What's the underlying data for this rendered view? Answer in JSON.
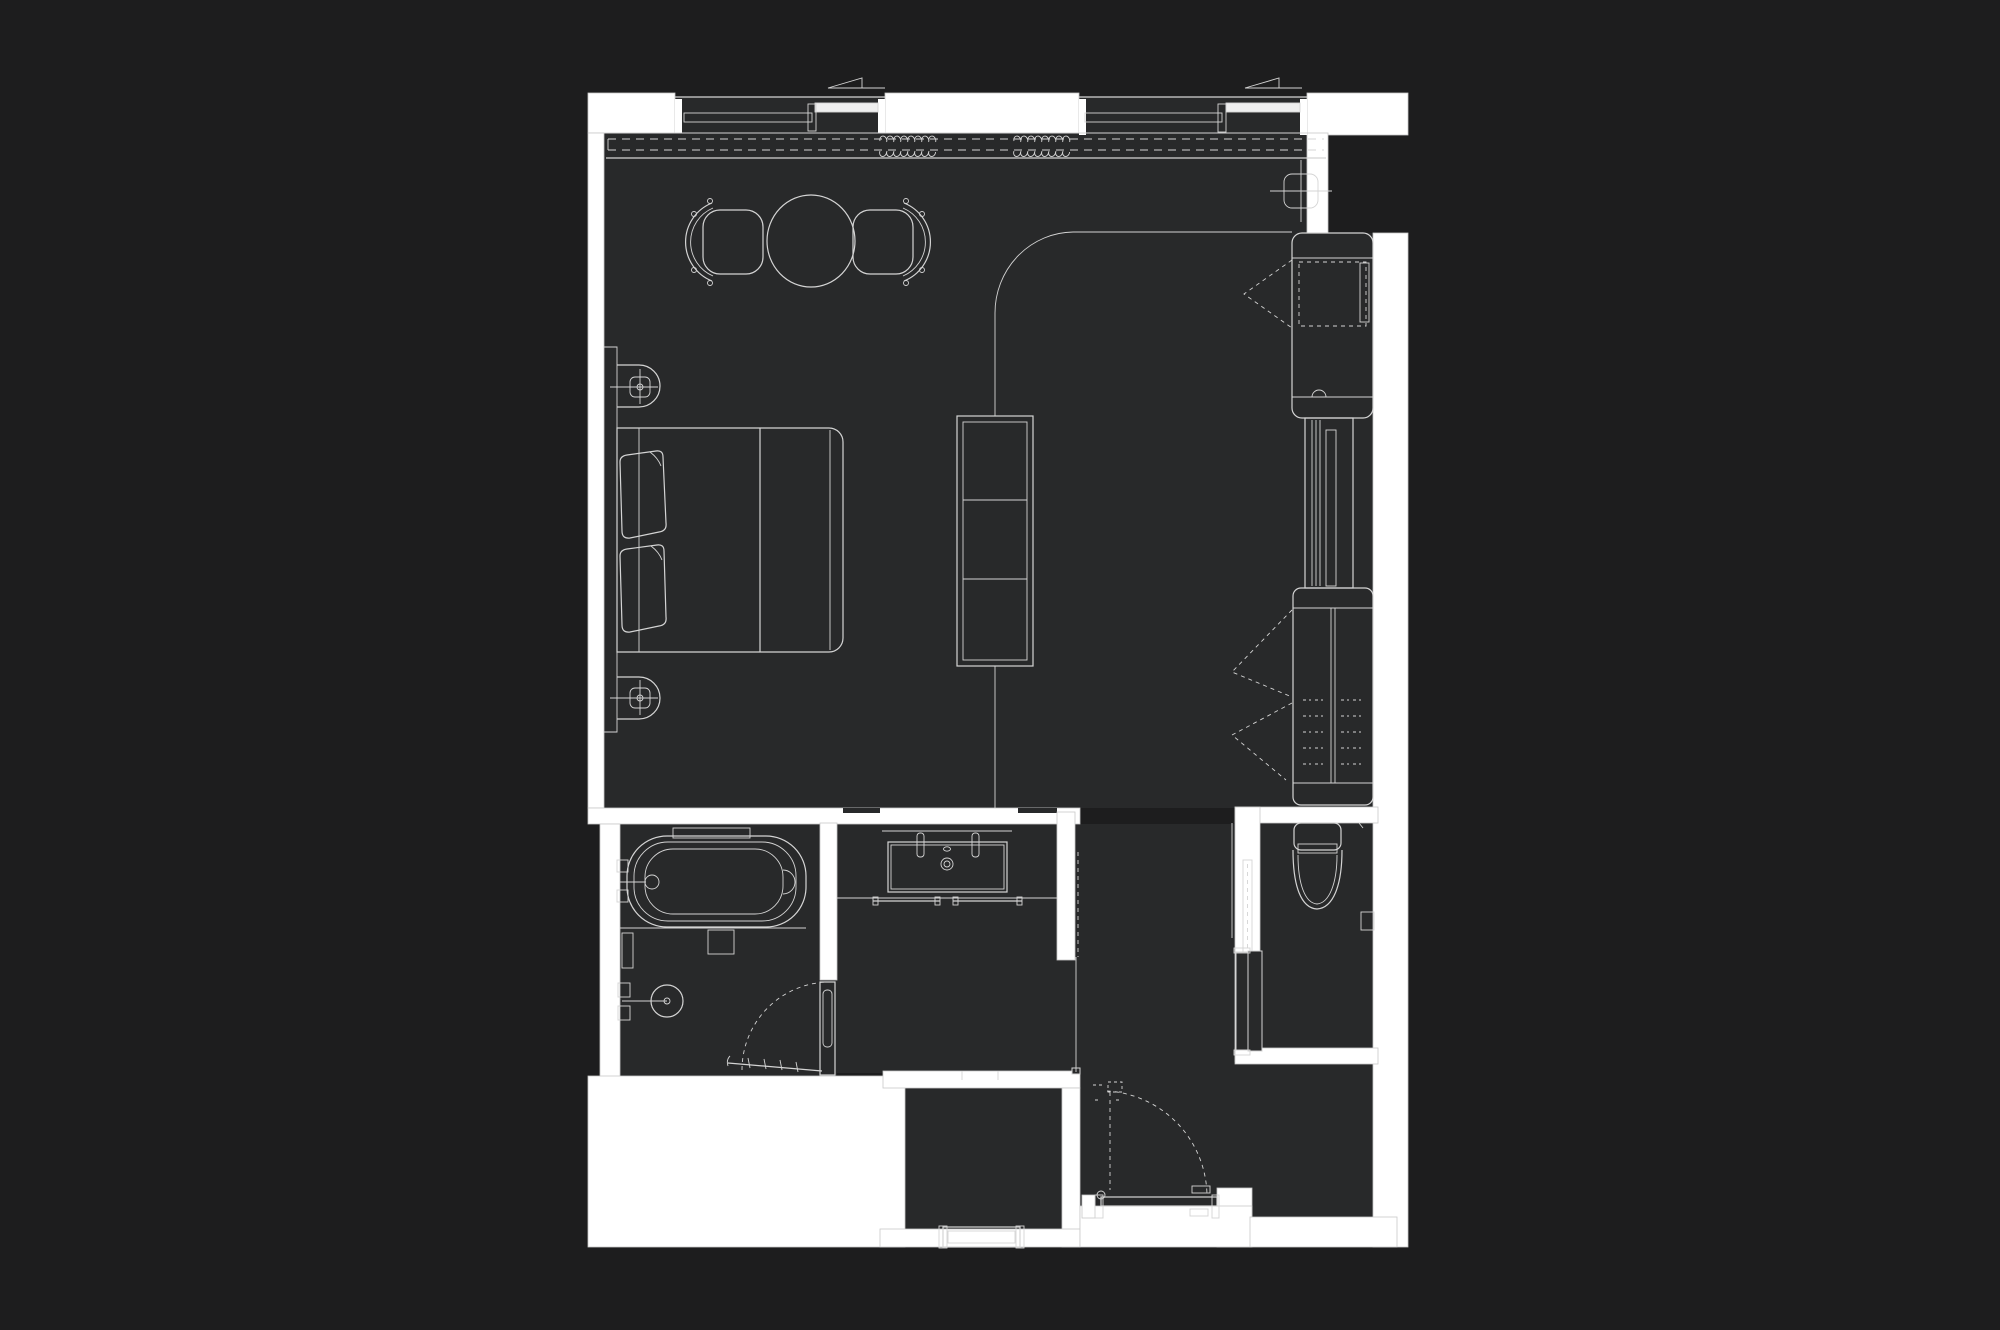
{
  "document": {
    "kind": "architectural floor plan",
    "description": "Dark-background CAD floor plan of a studio hotel suite, white wall fills and light gray line work, no visible text labels",
    "visible_text": []
  },
  "colors": {
    "background": "#1d1d1e",
    "floor": "#28292a",
    "wall": "#ffffff",
    "line": "#d4d4d4",
    "line_bright": "#ffffff"
  },
  "rooms": [
    {
      "name": "bedroom-living"
    },
    {
      "name": "bathtub-shower-room"
    },
    {
      "name": "vanity-lobby"
    },
    {
      "name": "wc-room"
    },
    {
      "name": "entry-corridor"
    },
    {
      "name": "storage-room"
    }
  ],
  "fixtures": [
    {
      "name": "window-left",
      "symbol": "sliding window with sash lines"
    },
    {
      "name": "window-right",
      "symbol": "sliding window with sash lines"
    },
    {
      "name": "curtain-track",
      "symbol": "double dashed line with coil bunches"
    },
    {
      "name": "dining-table",
      "symbol": "round table"
    },
    {
      "name": "dining-chair-left",
      "symbol": "barrel chair"
    },
    {
      "name": "dining-chair-right",
      "symbol": "barrel chair"
    },
    {
      "name": "wall-sconce-upper",
      "symbol": "stadium with crossed square"
    },
    {
      "name": "wall-sconce-lower",
      "symbol": "stadium with crossed square"
    },
    {
      "name": "double-bed",
      "symbol": "bed with two pillows and duvet fold"
    },
    {
      "name": "curved-partition-track",
      "symbol": "quarter-arc sliding track"
    },
    {
      "name": "divider-shelf-unit",
      "symbol": "three-cell open shelf"
    },
    {
      "name": "minibar-closet",
      "symbol": "cabinet with dashed door swing"
    },
    {
      "name": "tall-cabinet",
      "symbol": "slim vertical unit"
    },
    {
      "name": "wardrobe",
      "symbol": "closet with hanger dashes and bifold dashed chevrons"
    },
    {
      "name": "ceiling-light",
      "symbol": "rounded square with crosshair"
    },
    {
      "name": "bathtub",
      "symbol": "freestanding oval tub with wall faucet"
    },
    {
      "name": "bath-niche",
      "symbol": "wall recess shelf"
    },
    {
      "name": "shower-head",
      "symbol": "circle with wall arm and valves"
    },
    {
      "name": "shower-screen",
      "symbol": "ticked threshold line"
    },
    {
      "name": "bathroom-door",
      "symbol": "hinged door with dashed swing arc"
    },
    {
      "name": "vanity-sink",
      "symbol": "rectangular basin, two taps, drain"
    },
    {
      "name": "towel-bars",
      "symbol": "two wall bars"
    },
    {
      "name": "mirror-line",
      "symbol": "dashed vertical line"
    },
    {
      "name": "toilet",
      "symbol": "tank and elongated bowl"
    },
    {
      "name": "toilet-paper-holder",
      "symbol": "small wall box"
    },
    {
      "name": "wc-sliding-door",
      "symbol": "glass leaf with parked panels"
    },
    {
      "name": "entry-door",
      "symbol": "hinged door, open leaf with dashed closed position and swing arc"
    },
    {
      "name": "storage-bench",
      "symbol": "low bench at wall"
    }
  ]
}
